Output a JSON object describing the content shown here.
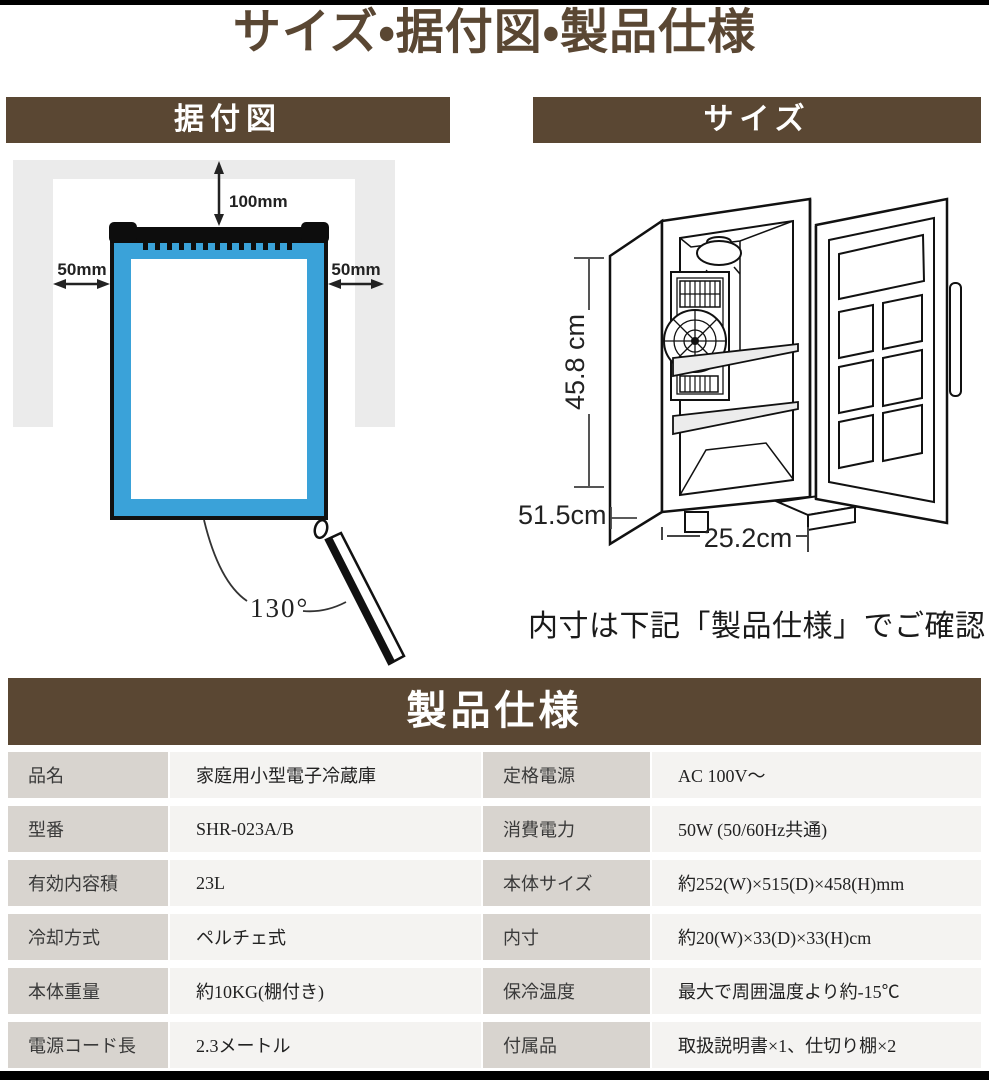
{
  "page_title": "サイズ・据付図・製品仕様",
  "colors": {
    "accent_brown": "#5a4733",
    "diagram_blue": "#3aa2d9",
    "wall_gray": "#ebebeb",
    "table_label_bg": "#d8d4cf",
    "table_value_bg": "#f4f3f1"
  },
  "installation": {
    "header": "据付図",
    "clearance_top": "100mm",
    "clearance_left": "50mm",
    "clearance_right": "50mm",
    "door_open_angle": "130°"
  },
  "size": {
    "header": "サイズ",
    "height_label": "45.8 cm",
    "depth_label": "51.5cm",
    "width_label": "25.2cm",
    "note": "内寸は下記「製品仕様」でご確認"
  },
  "spec": {
    "header": "製品仕様",
    "rows": [
      {
        "label1": "品名",
        "value1": "家庭用小型電子冷蔵庫",
        "label2": "定格電源",
        "value2": "AC 100V〜"
      },
      {
        "label1": "型番",
        "value1": "SHR-023A/B",
        "label2": "消費電力",
        "value2": "50W (50/60Hz共通)"
      },
      {
        "label1": "有効内容積",
        "value1": "23L",
        "label2": "本体サイズ",
        "value2": "約252(W)×515(D)×458(H)mm"
      },
      {
        "label1": "冷却方式",
        "value1": "ペルチェ式",
        "label2": "内寸",
        "value2": "約20(W)×33(D)×33(H)cm"
      },
      {
        "label1": "本体重量",
        "value1": "約10KG(棚付き)",
        "label2": "保冷温度",
        "value2": "最大で周囲温度より約-15℃"
      },
      {
        "label1": "電源コード長",
        "value1": "2.3メートル",
        "label2": "付属品",
        "value2": "取扱説明書×1、仕切り棚×2"
      }
    ]
  }
}
